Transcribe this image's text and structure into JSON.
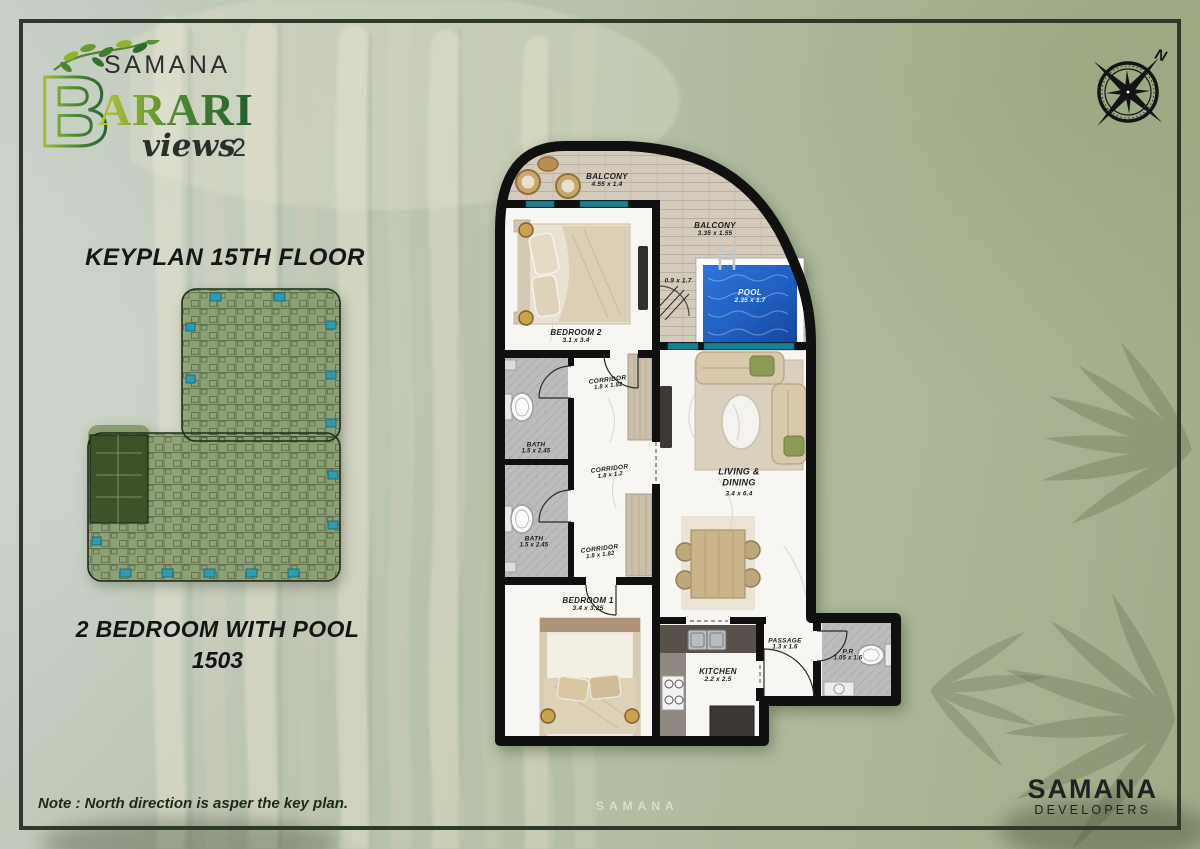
{
  "logo": {
    "brand_initial": "B",
    "brand_top": "SAMANA",
    "brand_main": "ARARI",
    "brand_script": "views",
    "brand_script_num": "2"
  },
  "compass": {
    "north_label": "N"
  },
  "keyplan": {
    "title": "KEYPLAN 15TH FLOOR"
  },
  "unit": {
    "title": "2 BEDROOM WITH POOL",
    "number": "1503"
  },
  "note": {
    "text": "Note : North direction is asper the key plan."
  },
  "developer": {
    "name": "SAMANA",
    "subtitle": "DEVELOPERS"
  },
  "background": {
    "building_sign": "SAMANA"
  },
  "floorplan": {
    "rooms": [
      {
        "key": "balcony-top",
        "name": "BALCONY",
        "dims": "4.55 x 1.4"
      },
      {
        "key": "balcony-right",
        "name": "BALCONY",
        "dims": "3.35 x 1.55"
      },
      {
        "key": "pool-deck",
        "name": "",
        "dims": "0.9 x 1.7"
      },
      {
        "key": "pool",
        "name": "POOL",
        "dims": "2.35 x 1.7"
      },
      {
        "key": "bedroom-2",
        "name": "BEDROOM 2",
        "dims": "3.1 x 3.4"
      },
      {
        "key": "corridor-top",
        "name": "CORRIDOR",
        "dims": "1.8 x 1.82"
      },
      {
        "key": "bath-1",
        "name": "BATH",
        "dims": "1.5 x 2.45"
      },
      {
        "key": "bath-2",
        "name": "BATH",
        "dims": "1.5 x 2.45"
      },
      {
        "key": "corridor-mid",
        "name": "CORRIDOR",
        "dims": "1.8 x 1.2"
      },
      {
        "key": "corridor-bottom",
        "name": "CORRIDOR",
        "dims": "1.8 x 1.82"
      },
      {
        "key": "living-dining",
        "name": "LIVING & DINING",
        "dims": "3.4 x 6.4"
      },
      {
        "key": "bedroom-1",
        "name": "BEDROOM 1",
        "dims": "3.4 x 3.25"
      },
      {
        "key": "kitchen",
        "name": "KITCHEN",
        "dims": "2.2 x 2.5"
      },
      {
        "key": "passage",
        "name": "PASSAGE",
        "dims": "1.3 x 1.6"
      },
      {
        "key": "powder-room",
        "name": "P.R",
        "dims": "1.05 x 1.6"
      }
    ]
  },
  "colors": {
    "frame_green": "#2c3a2a",
    "accent_teal": "#19808f",
    "pool_blue": "#1f5fc0",
    "wall_black": "#111111",
    "logo_green_light": "#a9c233",
    "logo_green_dark": "#2e6b33"
  }
}
